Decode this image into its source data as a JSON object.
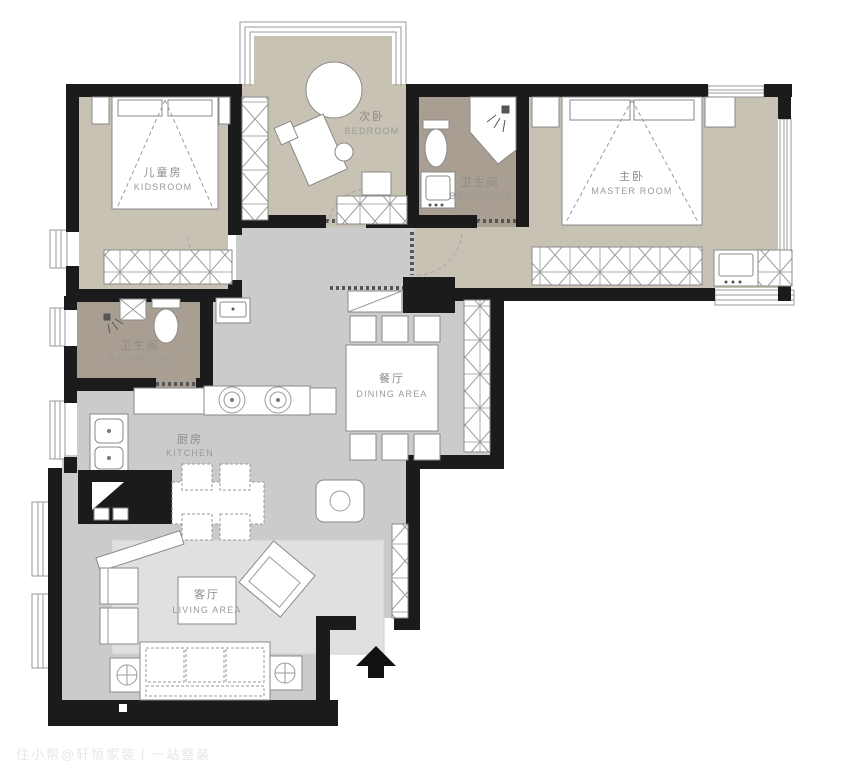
{
  "plan": {
    "type": "apartment-floorplan",
    "rooms": [
      {
        "id": "kidsroom",
        "zh": "儿童房",
        "en": "KIDSROOM"
      },
      {
        "id": "bedroom",
        "zh": "次卧",
        "en": "BEDROOM"
      },
      {
        "id": "bathroom1",
        "zh": "卫生间",
        "en": "BATHROOM"
      },
      {
        "id": "master",
        "zh": "主卧",
        "en": "MASTER ROOM"
      },
      {
        "id": "bathroom2",
        "zh": "卫生间",
        "en": "BATHROOM"
      },
      {
        "id": "dining",
        "zh": "餐厅",
        "en": "DINING AREA"
      },
      {
        "id": "kitchen",
        "zh": "厨房",
        "en": "KITCHEN"
      },
      {
        "id": "living",
        "zh": "客厅",
        "en": "LIVING AREA"
      }
    ],
    "colors": {
      "wall": "#1b1b1b",
      "bedroom_floor": "#c8c2b4",
      "bathroom_floor": "#a89e92",
      "hall_floor": "#cbcbcb",
      "rug": "#e0e0e0",
      "label_text": "#8b8b8b"
    },
    "watermark": "住小帮@轩恒家装丨一站整装"
  }
}
